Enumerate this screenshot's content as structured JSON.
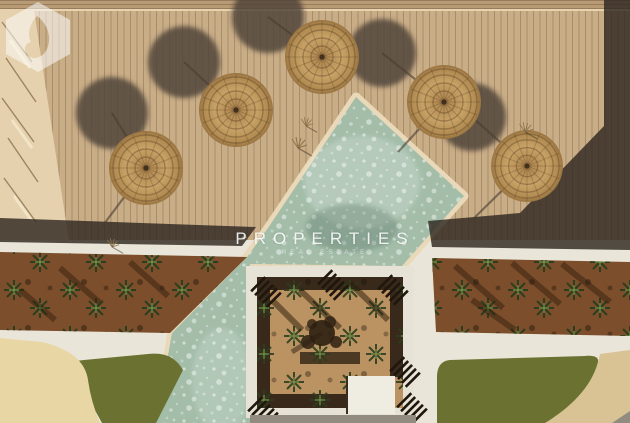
{
  "watermark": {
    "brand": "PROPERTIES",
    "tagline": "REAL ESTATE",
    "spark": "✦"
  },
  "scene": {
    "description": "Aerial top-down view of a resort: wooden sun deck with five straw umbrellas and their shadows, a diamond-shaped pool with cream border, planted garden beds, a central courtyard garden, lawns and sand-colored paths.",
    "umbrella_count": 5,
    "pool_shape": "rotated-square with lower arm"
  },
  "palette": {
    "deck": "#c9ad87",
    "deck_top_band": "#b89a74",
    "deck_shadow": "rgba(48,40,33,0.82)",
    "pale_strip": "#e5d1ad",
    "pool_water": "#a3bda9",
    "pool_border": "#e9d9b8",
    "walkway": "#eae5d9",
    "soil": "#7c4e2b",
    "courtyard_wall": "#e7e2d6",
    "courtyard_soil": "#bb9261",
    "dark_planting": "#38291a",
    "grass": "#6b7231",
    "sand": "#e8d7a4",
    "tan_path": "#d9c293",
    "grey_path": "#918b80",
    "umbrella_straw": "#c2985f",
    "shadow_circle": "#4e4237"
  }
}
